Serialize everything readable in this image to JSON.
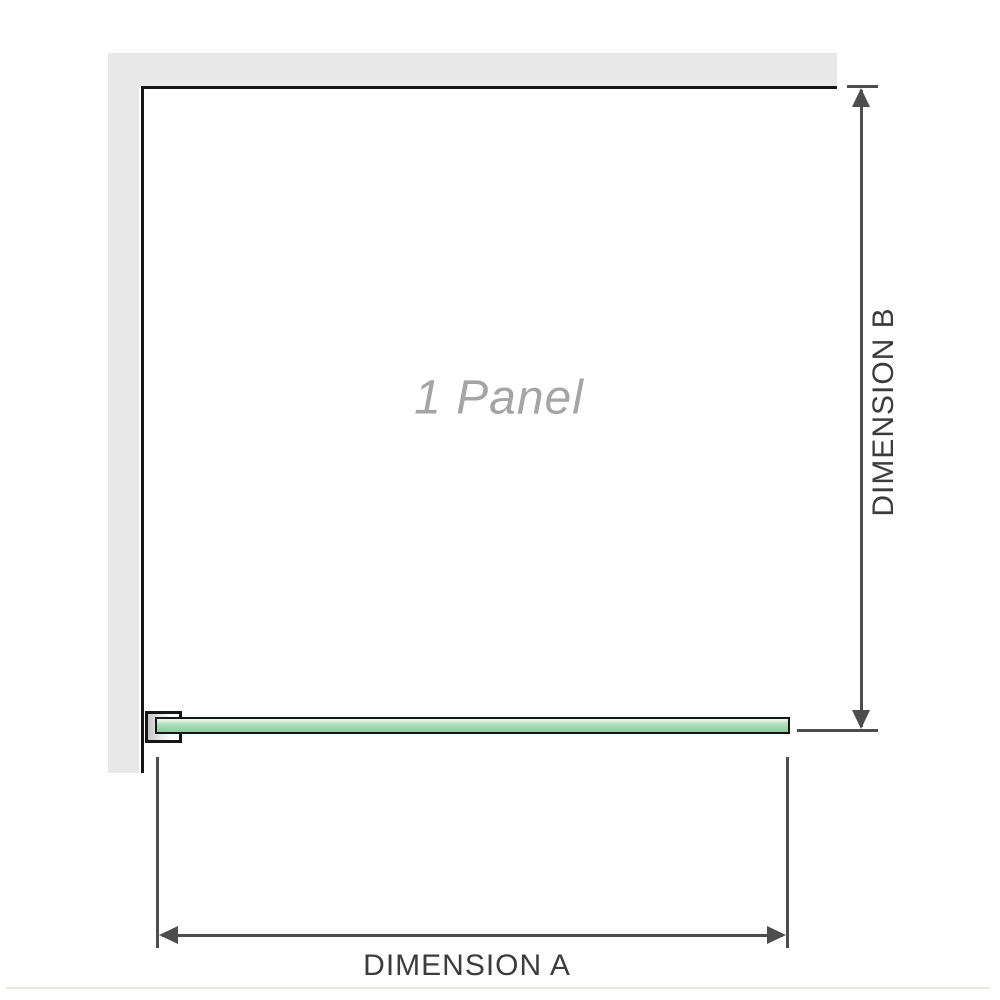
{
  "diagram": {
    "panel_label": "1 Panel",
    "dimension_a": {
      "label": "DIMENSION A"
    },
    "dimension_b": {
      "label": "DIMENSION B"
    }
  },
  "colors": {
    "background": "#ffffff",
    "wall": "#e8e8e8",
    "outline": "#161616",
    "dimension": "#4d4d4d",
    "label_text": "#3c3c3c",
    "panel_text": "#a5a5a5",
    "glass_light": "#e9f6ed",
    "glass_mid": "#aedcba",
    "glass_dark": "#8fcda0",
    "bracket_shadow": "#c6c6c6",
    "divider": "#e9e6e0"
  }
}
